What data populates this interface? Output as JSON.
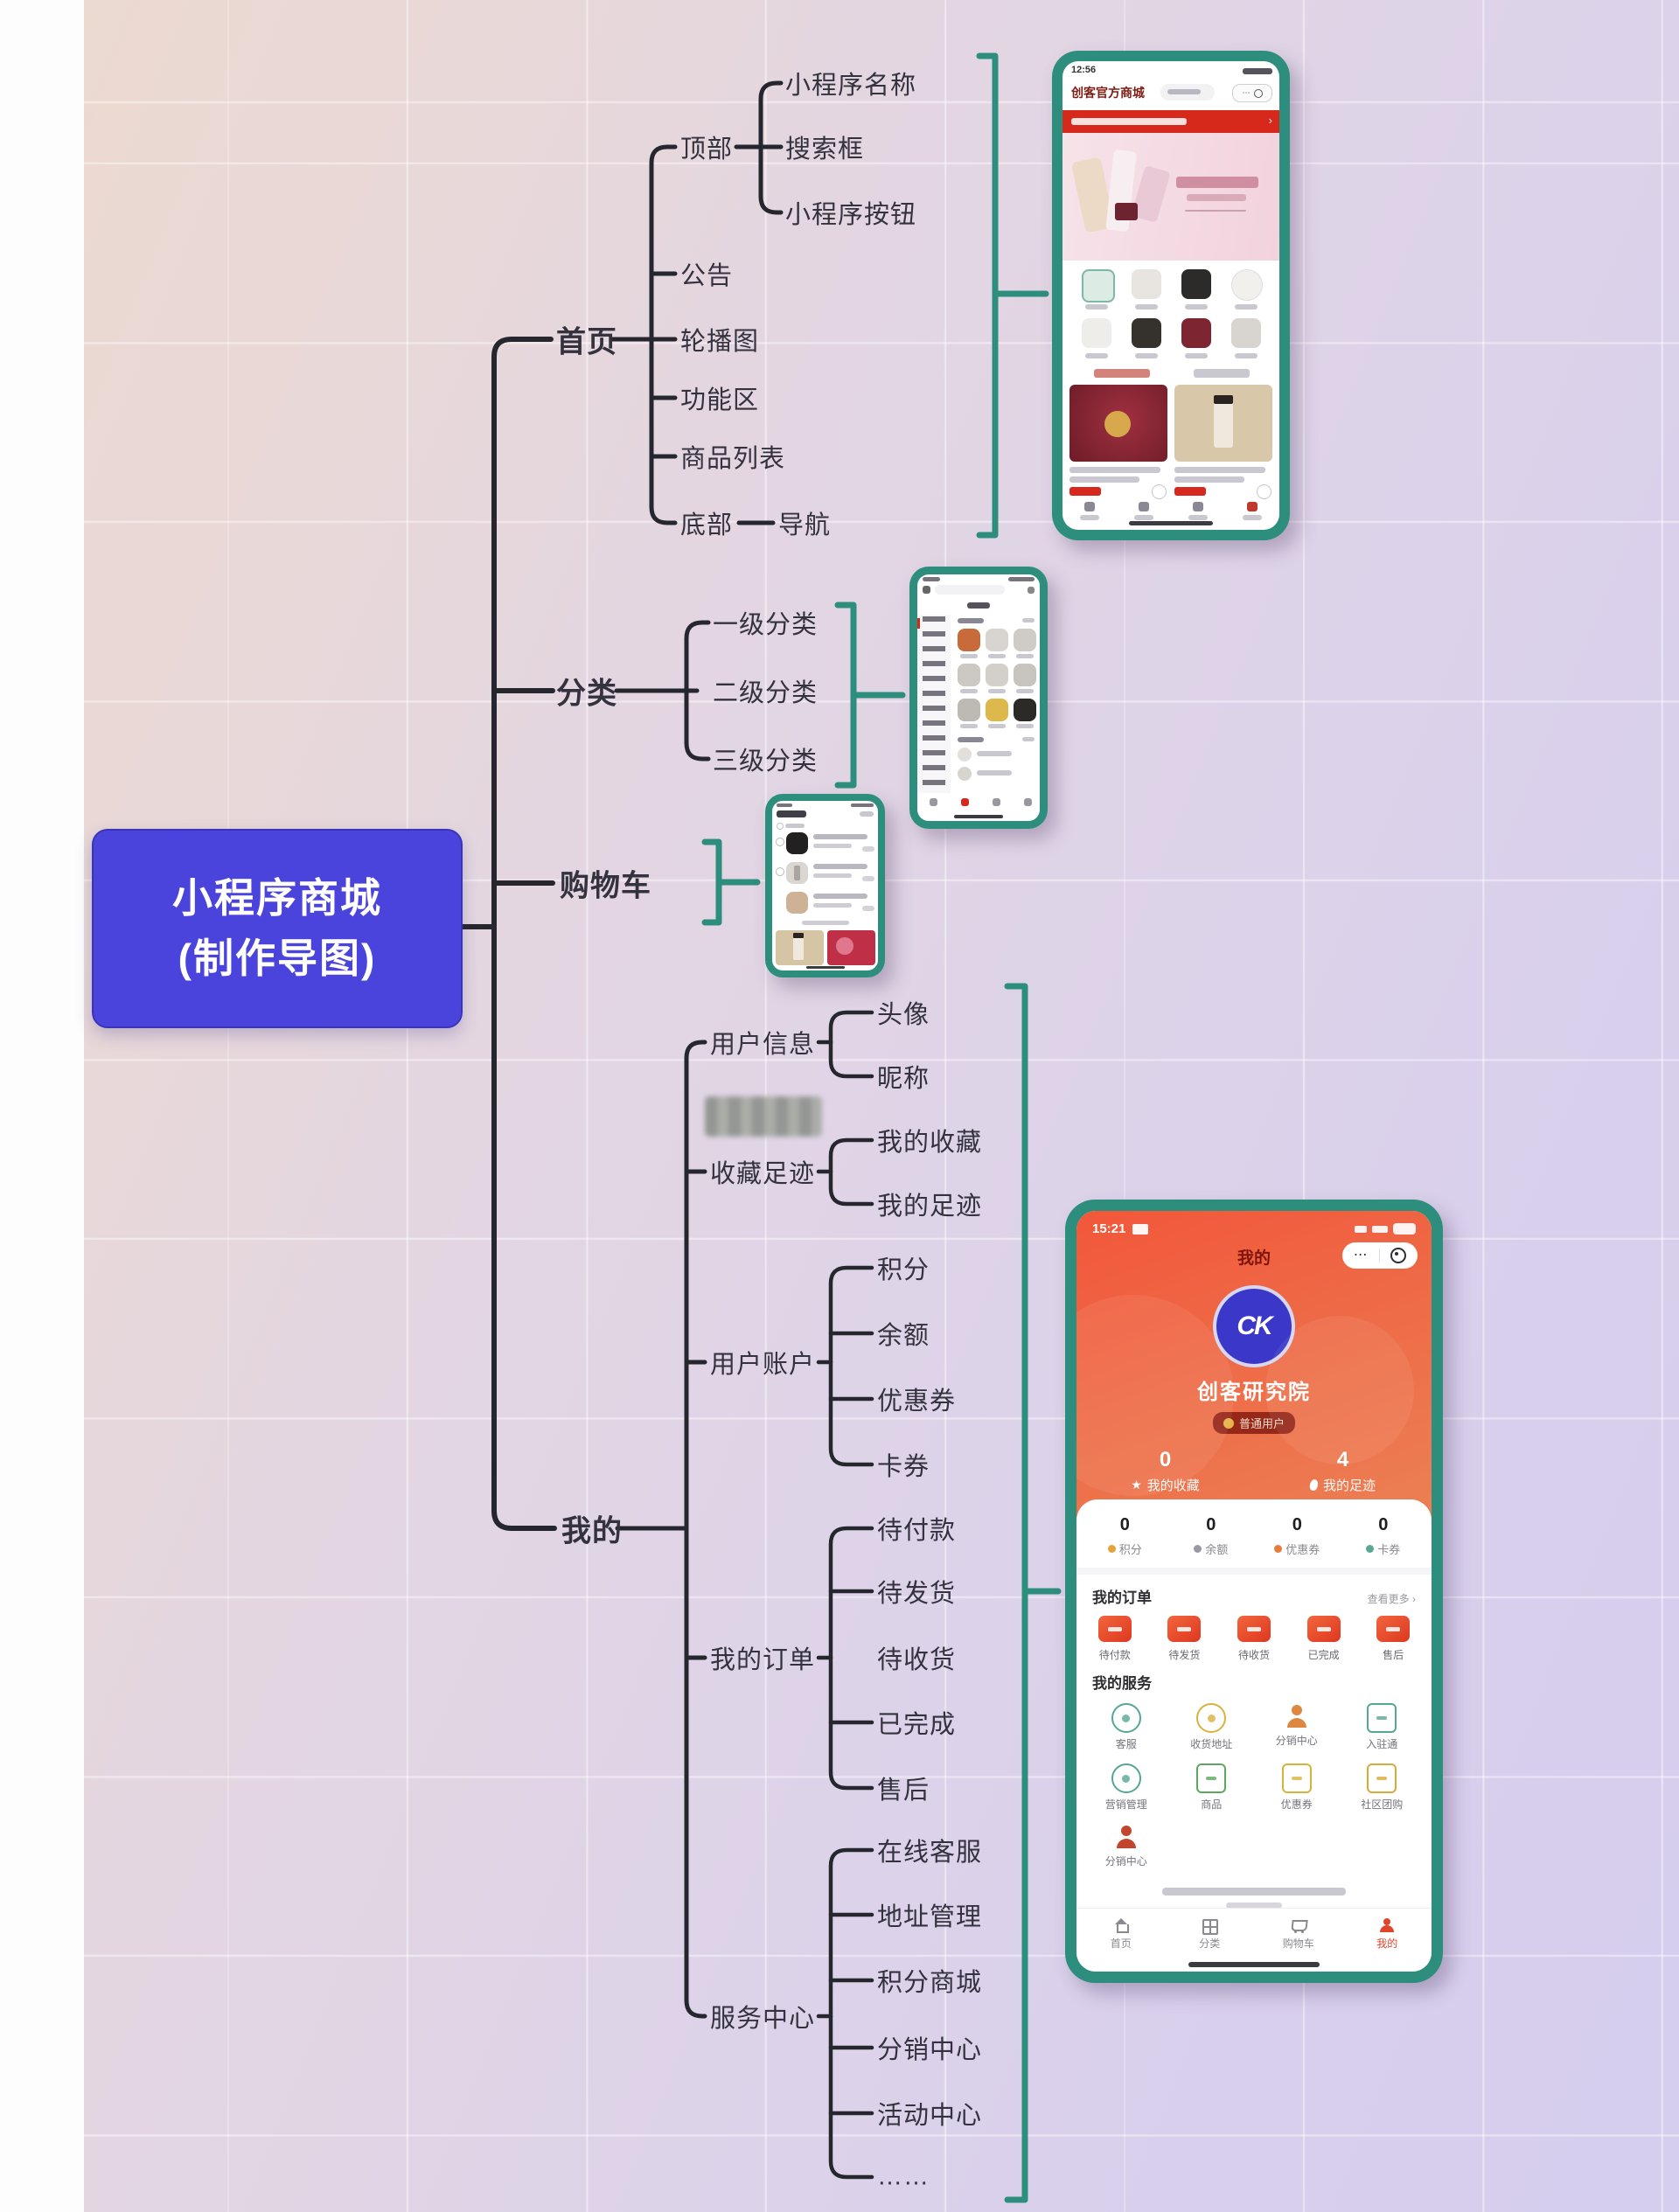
{
  "mindmap": {
    "root_line1": "小程序商城",
    "root_line2": "(制作导图)",
    "home": {
      "label": "首页",
      "top": "顶部",
      "top_children": [
        "小程序名称",
        "搜索框",
        "小程序按钮"
      ],
      "items": [
        "公告",
        "轮播图",
        "功能区",
        "商品列表"
      ],
      "bottom": "底部",
      "bottom_child": "导航"
    },
    "category": {
      "label": "分类",
      "children": [
        "一级分类",
        "二级分类",
        "三级分类"
      ]
    },
    "cart": {
      "label": "购物车"
    },
    "mine": {
      "label": "我的",
      "groups": [
        {
          "label": "用户信息",
          "children": [
            "头像",
            "昵称"
          ]
        },
        {
          "label": "收藏足迹",
          "children": [
            "我的收藏",
            "我的足迹"
          ]
        },
        {
          "label": "用户账户",
          "children": [
            "积分",
            "余额",
            "优惠券",
            "卡券"
          ]
        },
        {
          "label": "我的订单",
          "children": [
            "待付款",
            "待发货",
            "待收货",
            "已完成",
            "售后"
          ]
        },
        {
          "label": "服务中心",
          "children": [
            "在线客服",
            "地址管理",
            "积分商城",
            "分销中心",
            "活动中心",
            "……"
          ]
        }
      ]
    }
  },
  "screens": {
    "home_app": {
      "status_time": "12:56",
      "title": "创客官方商城",
      "notice_more": "›"
    },
    "profile_app": {
      "status_time": "15:21",
      "nav_title": "我的",
      "avatar_glyph": "CK",
      "nickname": "创客研究院",
      "badge": "普通用户",
      "stats": [
        {
          "value": "0",
          "label": "我的收藏"
        },
        {
          "value": "4",
          "label": "我的足迹"
        }
      ],
      "wallet": [
        {
          "value": "0",
          "label": "积分"
        },
        {
          "value": "0",
          "label": "余额"
        },
        {
          "value": "0",
          "label": "优惠券"
        },
        {
          "value": "0",
          "label": "卡券"
        }
      ],
      "orders_title": "我的订单",
      "orders_more": "查看更多 ›",
      "order_items": [
        "待付款",
        "待发货",
        "待收货",
        "已完成",
        "售后"
      ],
      "services_title": "我的服务",
      "service_items": [
        "客服",
        "收货地址",
        "分销中心",
        "入驻通",
        "营销管理",
        "商品",
        "优惠券",
        "社区团购",
        "分销中心"
      ],
      "tabbar": [
        "首页",
        "分类",
        "购物车",
        "我的"
      ]
    }
  },
  "colors": {
    "accent_teal": "#2e8e7d",
    "root_blue": "#4b44dc",
    "notice_red": "#d7281c",
    "profile_red": "#ee5a3a",
    "active_tab": "#e0452c"
  }
}
